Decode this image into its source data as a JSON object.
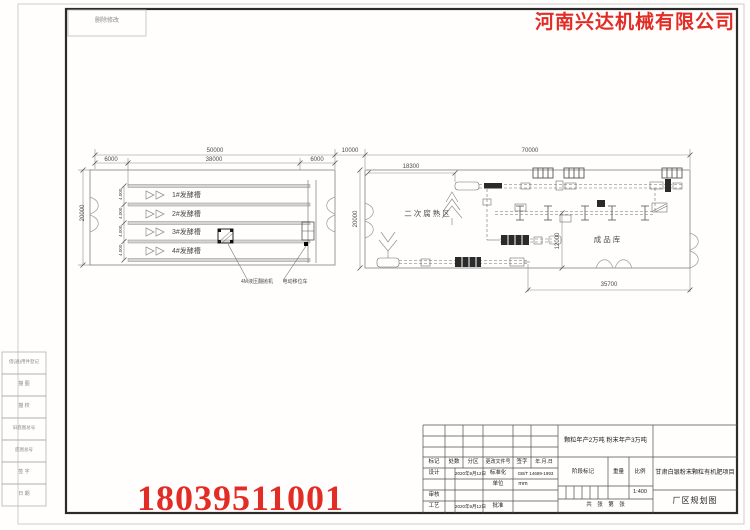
{
  "page": {
    "note_box": "删除修改",
    "company": "河南兴达机械有限公司",
    "phone": "18039511001"
  },
  "margin_labels": [
    "借(通)用件登记",
    "描 图",
    "描 校",
    "旧底图总号",
    "底图总号",
    "签 字",
    "日 期"
  ],
  "left_plan": {
    "dim_total_width": "50000",
    "dim_left_bay": "6000",
    "dim_mid_bay": "38000",
    "dim_right_bay": "6000",
    "dim_height": "20000",
    "channel_dims": [
      "4.000",
      "4.000",
      "4.000",
      "4.000"
    ],
    "tanks": [
      "1#发酵槽",
      "2#发酵槽",
      "3#发酵槽",
      "4#发酵槽"
    ],
    "callout_left": "4M液压翻抛机",
    "callout_right": "电动移位车"
  },
  "right_plan": {
    "dim_gap": "10000",
    "dim_total_width": "70000",
    "dim_inner": "18300",
    "dim_height": "20000",
    "dim_store_height": "12000",
    "dim_bottom": "35700",
    "area_label": "二次腐熟区",
    "store_label": "成品库"
  },
  "title_block": {
    "capacity": "颗粒年产2万吨  粉末年产3万吨",
    "project": "甘肃白银粉末颗粒有机肥项目",
    "drawing_title": "厂区规划图",
    "scale_value": "1:400",
    "header": {
      "mark": "标记",
      "count": "处数",
      "zone": "分区",
      "change_no": "更改文件号",
      "sign": "签字",
      "date": "年.月.日"
    },
    "rows": {
      "design_label": "设计",
      "design_date": "2020年9月12日",
      "standard_label": "标准化",
      "standard_value": "GB/T 14689-1993",
      "unit_label": "单位",
      "unit_value": "mm",
      "review_label": "审核",
      "process_label": "工艺",
      "process_date": "2020年9月12日",
      "approve_label": "批准"
    },
    "stage": {
      "stage_label": "阶段标记",
      "weight_label": "重量",
      "scale_label": "比例"
    },
    "sheet_note": "共　张　第　张"
  },
  "colors": {
    "accent_red": "#e22c26",
    "line_gray": "#8a8a8a"
  }
}
